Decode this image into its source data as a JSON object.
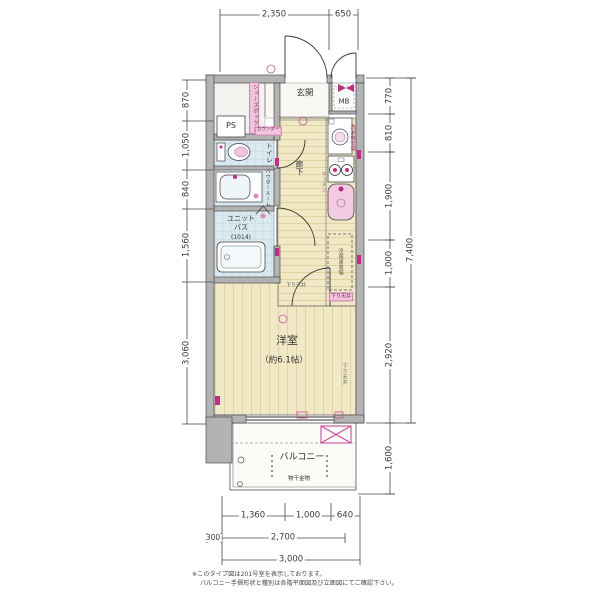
{
  "dims": {
    "top": [
      "2,350",
      "650"
    ],
    "left": [
      "870",
      "1,050",
      "840",
      "1,560",
      "3,060"
    ],
    "right": [
      "770",
      "810",
      "1,900",
      "1,000",
      "2,920"
    ],
    "total_right": "7,400",
    "balcony_right": "1,600",
    "bottom1": [
      "1,360",
      "1,000",
      "640"
    ],
    "bottom2": [
      "300",
      "2,700"
    ],
    "bottom3": "3,000"
  },
  "labels": {
    "genkan": "玄関",
    "mb": "MB",
    "ps": "PS",
    "shoebox": "シューズボックス",
    "counter": "カウンター",
    "toilet": "トイレ",
    "powder": "パウダールーム",
    "bath1": "ユニット",
    "bath2": "バス",
    "bath3": "(1014)",
    "hallway": "廊下",
    "kitchen": "キッチン",
    "washer": "洗濯機置場",
    "fridge": "冷蔵庫置場",
    "soffit": "下り天井",
    "room": "洋室",
    "room_size": "（約6.1帖）",
    "balcony": "バルコニー",
    "laundry": "物干金物"
  },
  "footnotes": [
    "※このタイプ図は201号室を表示しております。",
    "バルコニー手摺形状と種別は各階平面図及び立面図にてご確認下さい。"
  ],
  "colors": {
    "wall": "#b3b3b3",
    "wood_floor": "#f1e9c6",
    "plank_line": "#d9c992",
    "wet_floor": "#dae9ef",
    "accent_pink": "#c02c86",
    "light_pink": "#f2c5dc",
    "dimension_line": "#4a4a4a"
  }
}
